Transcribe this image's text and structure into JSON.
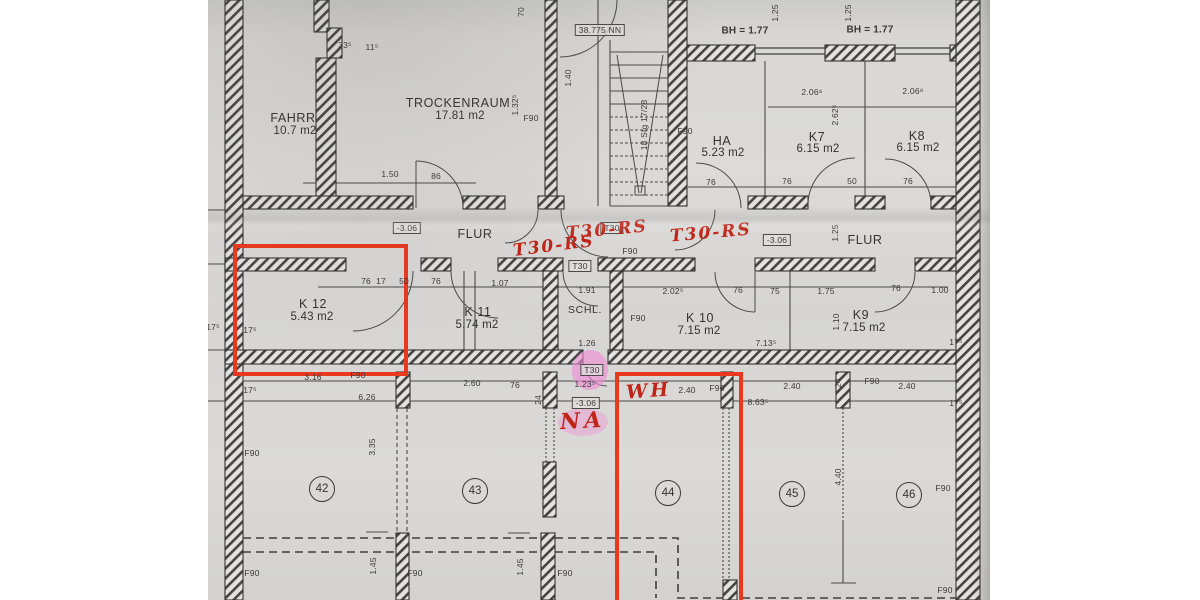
{
  "colors": {
    "annotation_red": "#bf2417",
    "marker_red": "#e8391f",
    "highlight_pink": "#f18ad6"
  },
  "rooms": [
    {
      "name": "FAHRR",
      "area": "10.7 m2"
    },
    {
      "name": "TROCKENRAUM",
      "area": "17.81 m2"
    },
    {
      "name": "HA",
      "area": "5.23 m2"
    },
    {
      "name": "K7",
      "area": "6.15 m2"
    },
    {
      "name": "K8",
      "area": "6.15 m2"
    },
    {
      "name": "FLUR",
      "area": ""
    },
    {
      "name": "FLUR",
      "area": ""
    },
    {
      "name": "K 12",
      "area": "5.43 m2"
    },
    {
      "name": "K 11",
      "area": "5.74 m2"
    },
    {
      "name": "SCHL.",
      "area": ""
    },
    {
      "name": "K 10",
      "area": "7.15 m2"
    },
    {
      "name": "K9",
      "area": "7.15 m2"
    }
  ],
  "cellar_numbers": [
    "42",
    "43",
    "44",
    "45",
    "46"
  ],
  "datum_box": "38.775 NN",
  "window_height_1": "BH = 1.77",
  "window_height_2": "BH = 1.77",
  "stair_text": "18 Stg 17/28",
  "level_mark": "-3.06",
  "fire_rating": "F90",
  "door_rating": "T30",
  "annotations": {
    "t30rs_1": "T30-RS",
    "t30rs_2": "T30-RS",
    "t30rs_3": "T30-RS",
    "wh": "WH",
    "na": "NA"
  },
  "dims": {
    "d33": "33⁵",
    "d11": "11⁵",
    "d70": "70",
    "d125": "1.25",
    "d206": "2.06⁸",
    "d262": "2.62⁵",
    "d150": "1.50",
    "d86": "86",
    "d76": "76",
    "d50": "50",
    "d17": "17",
    "d140": "1.40",
    "d132": "1.32⁵",
    "d191": "1.91",
    "d126": "1.26",
    "d123": "1.23⁵",
    "d107": "1.07",
    "d17s": "17⁵",
    "d202": "2.02⁵",
    "d75": "75",
    "d175": "1.75",
    "d100": "1.00",
    "d713": "7.13⁵",
    "d110": "1.10",
    "d316": "3.16",
    "d626": "6.26",
    "d260": "2.60",
    "d24": "24",
    "d240": "2.40",
    "d863": "8.63⁵",
    "d335": "3.35",
    "d440": "4.40",
    "d145": "1.45"
  }
}
